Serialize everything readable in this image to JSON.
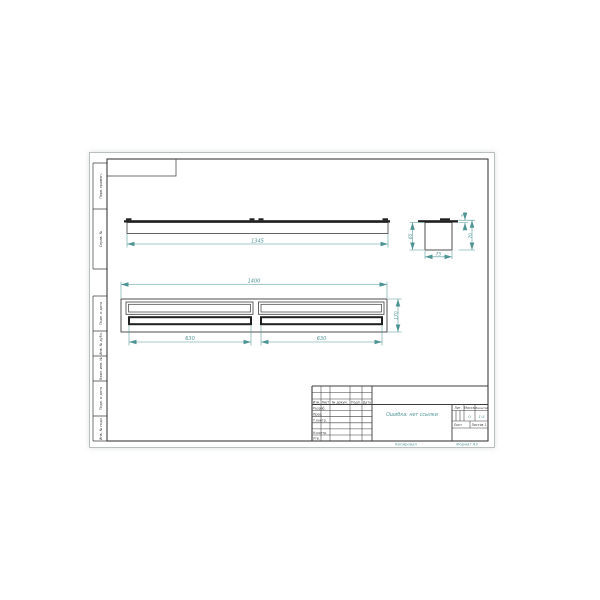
{
  "colors": {
    "accent_teal": "#4f9494",
    "line_dark": "#3c3c3c",
    "thick_line": "#1f1f1f"
  },
  "margin_column": {
    "top": [
      "Перв. примен.",
      "Справ. №"
    ],
    "bottom": [
      "Подп. и дата",
      "Инв. № дубл.",
      "Взам. инв. №",
      "Подп. и дата",
      "Инв. № подл."
    ]
  },
  "front_view": {
    "length": "1345"
  },
  "side_view": {
    "flange_thickness": "5",
    "overall_height": "70",
    "body_height": "65",
    "width": "75"
  },
  "plan_view": {
    "overall_length": "1400",
    "slot_left": "630",
    "slot_right": "630",
    "depth": "170"
  },
  "title_block": {
    "cols": {
      "izm": "Изм.",
      "list": "Лист",
      "doc": "№ докум.",
      "podp": "Подп.",
      "data": "Дата"
    },
    "rows": {
      "razrab": "Разраб.",
      "prov": "Пров.",
      "tkontr": "Т.контр.",
      "nkontr": "Н.контр.",
      "utv": "Утв."
    },
    "name": "Ошибка: нет ссылки",
    "lit_label": "Лит.",
    "mass_label": "Масса",
    "scale_label": "Масштаб",
    "mass_value": "0",
    "scale_value": "1:5",
    "list_label": "Лист",
    "listov_label": "Листов",
    "listov_value": "1"
  },
  "footer": {
    "copy": "Копировал",
    "format": "Формат А3"
  }
}
